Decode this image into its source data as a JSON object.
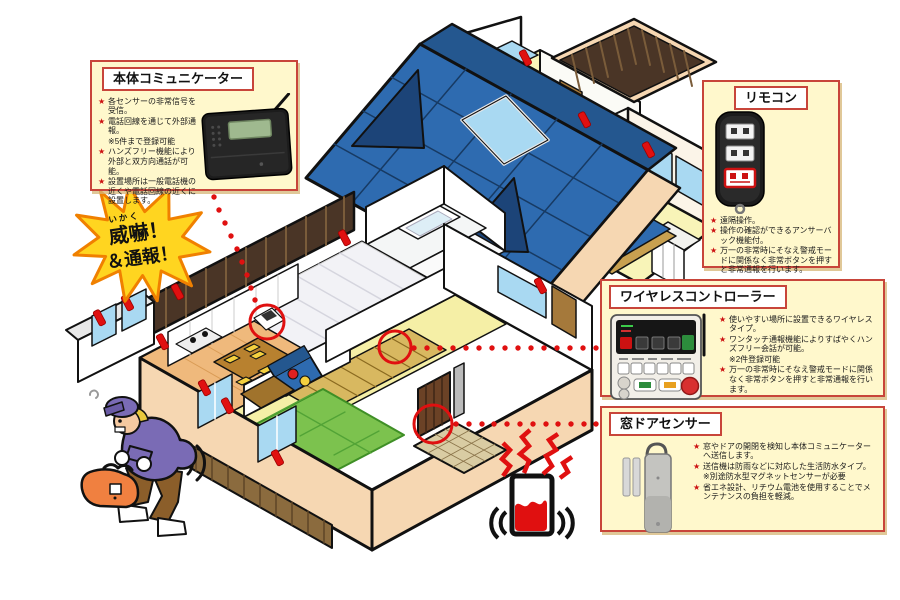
{
  "diagram_subject": "ホームセキュリティシステム構成図",
  "icons": {
    "star": "★"
  },
  "colors": {
    "callout_bg": "#FFF8CC",
    "callout_border": "#C8453A",
    "roof_blue": "#2E6BB0",
    "roof_dark": "#1C4478",
    "wall_cream": "#F6D7B2",
    "window_blue": "#A9D9F2",
    "sensor_red": "#E01010",
    "tatami_green": "#7CC24E",
    "burst_yellow": "#FFD520",
    "burst_orange": "#F08000"
  },
  "burst": {
    "furigana": "いかく",
    "line1": "威嚇！",
    "line2": "＆通報！"
  },
  "callouts": {
    "communicator": {
      "title": "本体コミュニケーター",
      "bullets": [
        {
          "marker": "★",
          "text": "各センサーの非常信号を受信。"
        },
        {
          "marker": "★",
          "text": "電話回線を通じて外部通報。"
        },
        {
          "marker": "",
          "text": "※5件まで登録可能"
        },
        {
          "marker": "★",
          "text": "ハンズフリー機能により外部と双方向通話が可能。"
        },
        {
          "marker": "★",
          "text": "設置場所は一般電話機の近くや電話回線の近くに設置します。"
        }
      ]
    },
    "remote": {
      "title": "リモコン",
      "bullets": [
        {
          "marker": "★",
          "text": "遠隔操作。"
        },
        {
          "marker": "★",
          "text": "操作の確認ができるアンサーバック機能付。"
        },
        {
          "marker": "★",
          "text": "万一の非常時にそなえ警戒モードに関係なく非常ボタンを押すと非常通報を行います。"
        }
      ]
    },
    "wireless": {
      "title": "ワイヤレスコントローラー",
      "bullets": [
        {
          "marker": "★",
          "text": "使いやすい場所に設置できるワイヤレスタイプ。"
        },
        {
          "marker": "★",
          "text": "ワンタッチ通報機能によりすばやくハンズフリー会話が可能。"
        },
        {
          "marker": "",
          "text": "※2件登録可能"
        },
        {
          "marker": "★",
          "text": "万一の非常時にそなえ警戒モードに関係なく非常ボタンを押すと非常通報を行います。"
        }
      ]
    },
    "door_sensor": {
      "title": "窓ドアセンサー",
      "bullets": [
        {
          "marker": "★",
          "text": "窓やドアの開閉を検知し本体コミュニケーターへ送信します。"
        },
        {
          "marker": "★",
          "text": "送信機は防雨などに対応した生活防水タイプ。"
        },
        {
          "marker": "",
          "text": "※別途防水型マグネットセンサーが必要"
        },
        {
          "marker": "★",
          "text": "省エネ設計、リチウム電池を使用することでメンテナンスの負担を軽減。"
        }
      ]
    }
  }
}
